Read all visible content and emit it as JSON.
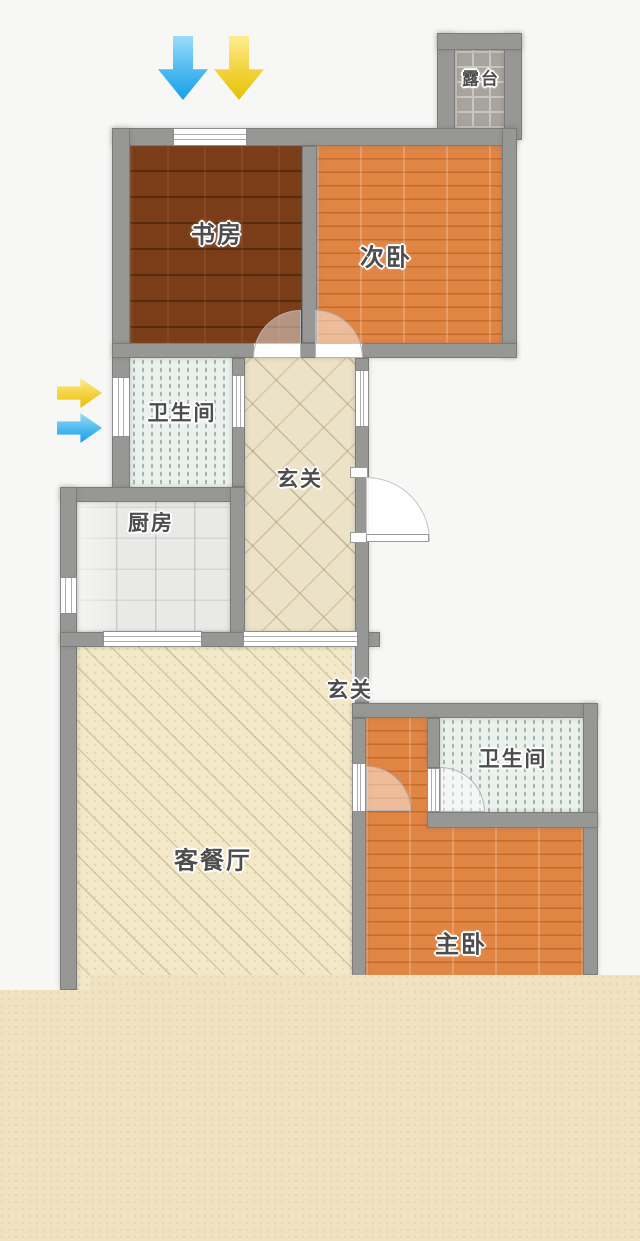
{
  "plan": {
    "type": "apartment-floor-plan",
    "rooms": {
      "study": {
        "label": "书房"
      },
      "bedroom2": {
        "label": "次卧"
      },
      "terrace": {
        "label": "露台"
      },
      "bath1": {
        "label": "卫生间"
      },
      "hall1": {
        "label": "玄关"
      },
      "kitchen": {
        "label": "厨房"
      },
      "hall2": {
        "label": "玄关"
      },
      "living": {
        "label": "客餐厅"
      },
      "bath2": {
        "label": "卫生间"
      },
      "master": {
        "label": "主卧"
      }
    },
    "icons": {
      "top_arrows": [
        "arrow-down-blue",
        "arrow-down-yellow"
      ],
      "left_arrows": [
        "arrow-right-yellow",
        "arrow-right-blue"
      ]
    },
    "colors": {
      "wall": "#979795",
      "page_background": "#f7f7f6",
      "bottom_mask": "#f0e3c1",
      "dark_wood_floor": "#6f3312",
      "orange_wood_floor": "#d97c38",
      "bath_tile": "#edf1ee",
      "hall_tile": "#ece2c8",
      "kitchen_tile": "#e9e9e7",
      "living_tile": "#f3e9c8",
      "terrace_tile": "#a7a39d",
      "arrow_blue": "#189fe8",
      "arrow_yellow": "#e4c204",
      "label_text": "#4d4d4d"
    }
  }
}
